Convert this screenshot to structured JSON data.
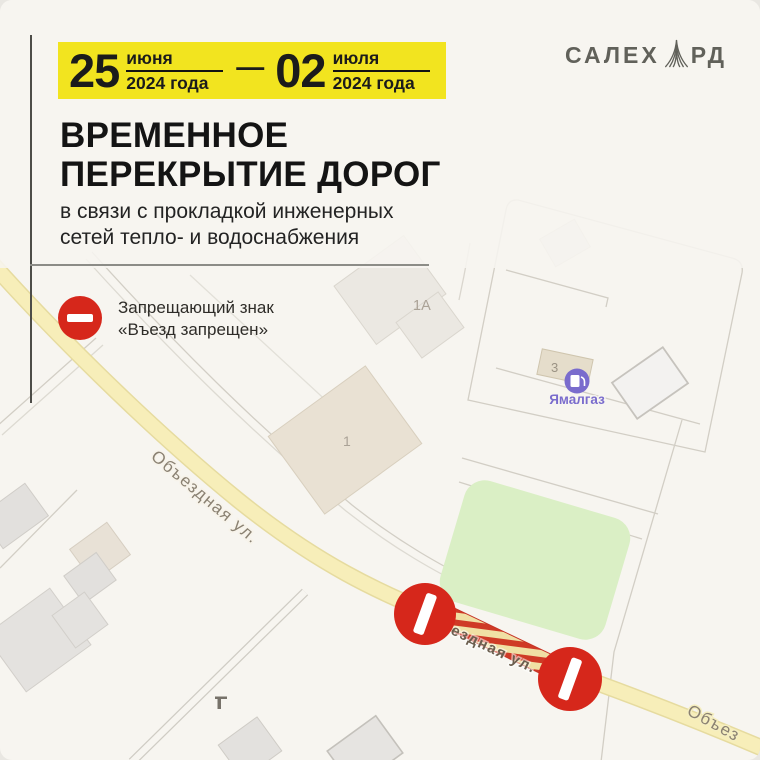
{
  "poster": {
    "banner": {
      "start_day": "25",
      "start_month": "июня",
      "start_year": "2024 года",
      "separator": "—",
      "end_day": "02",
      "end_month": "июля",
      "end_year": "2024 года"
    },
    "logo": {
      "left": "САЛЕХ",
      "right": "РД"
    },
    "title": {
      "line1": "ВРЕМЕННОЕ",
      "line2": "ПЕРЕКРЫТИЕ ДОРОГ"
    },
    "subtitle": {
      "line1": "в связи с прокладкой инженерных",
      "line2": "сетей тепло- и водоснабжения"
    },
    "legend": {
      "line1": "Запрещающий знак",
      "line2": "«Въезд запрещен»"
    }
  },
  "map": {
    "streets": {
      "main": "Объездная ул.",
      "closed_fragment": "ездная ул.",
      "bottom_right": "Объез"
    },
    "buildings": {
      "b1a": "1А",
      "b1": "1",
      "b3": "3"
    },
    "poi": {
      "gas_label": "Ямалгаз"
    }
  },
  "colors": {
    "background": "#f7f5f0",
    "banner_yellow": "#f2e41f",
    "sign_red": "#d6271b",
    "road_yellow": "#f7eeb9",
    "closure_hatch_red": "#cf3a26",
    "green_area": "#daefc5",
    "gas_purple": "#7a6ccd"
  }
}
